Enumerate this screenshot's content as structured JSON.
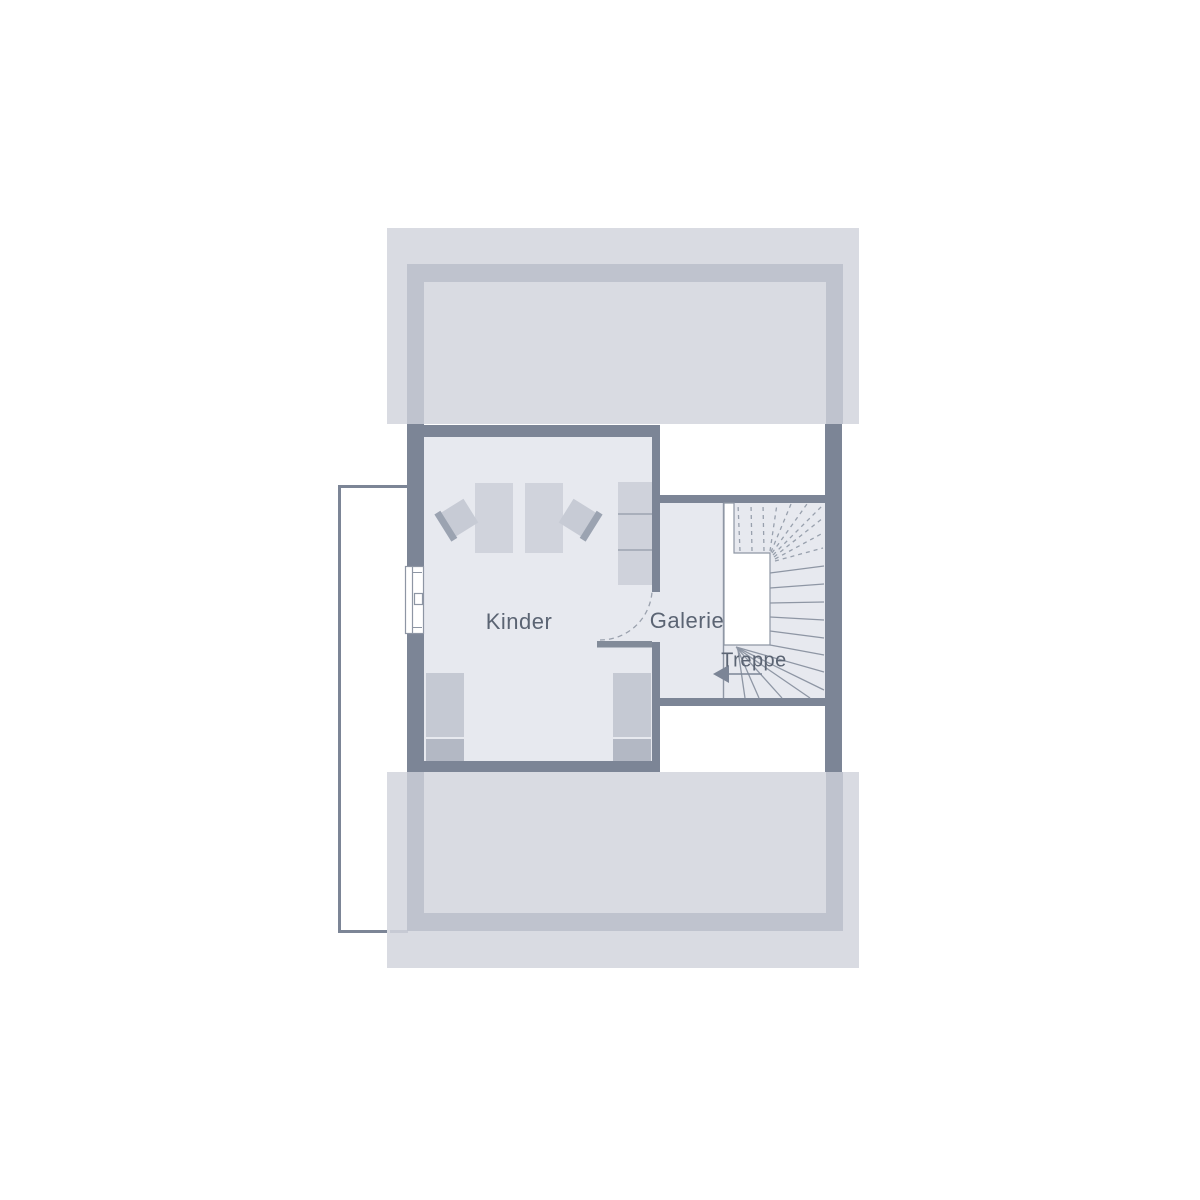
{
  "floorplan": {
    "type": "attic-floor-plan",
    "rooms": [
      {
        "id": "kinder",
        "label": "Kinder"
      },
      {
        "id": "galerie",
        "label": "Galerie"
      },
      {
        "id": "treppe",
        "label": "Treppe"
      }
    ],
    "stair": {
      "direction_arrow": "left",
      "style": "winder-stair-with-open-well"
    },
    "furniture": {
      "kinder": [
        "desk",
        "desk",
        "chair",
        "chair",
        "wardrobe",
        "bed",
        "bed"
      ],
      "exterior": [
        "balcony"
      ]
    },
    "colors": {
      "background": "#ffffff",
      "roof_slab": "#d9dbe2",
      "roof_level_wall": "#bfc3ce",
      "wall": "#7c8596",
      "floor": "#e7e9ef",
      "furniture_light": "#d0d3dc",
      "furniture_dark": "#b3b8c4",
      "chair_back": "#9ba3b1",
      "stair_line": "#8e96a4",
      "label_text": "#5b6473",
      "stair_well": "#ffffff"
    }
  }
}
